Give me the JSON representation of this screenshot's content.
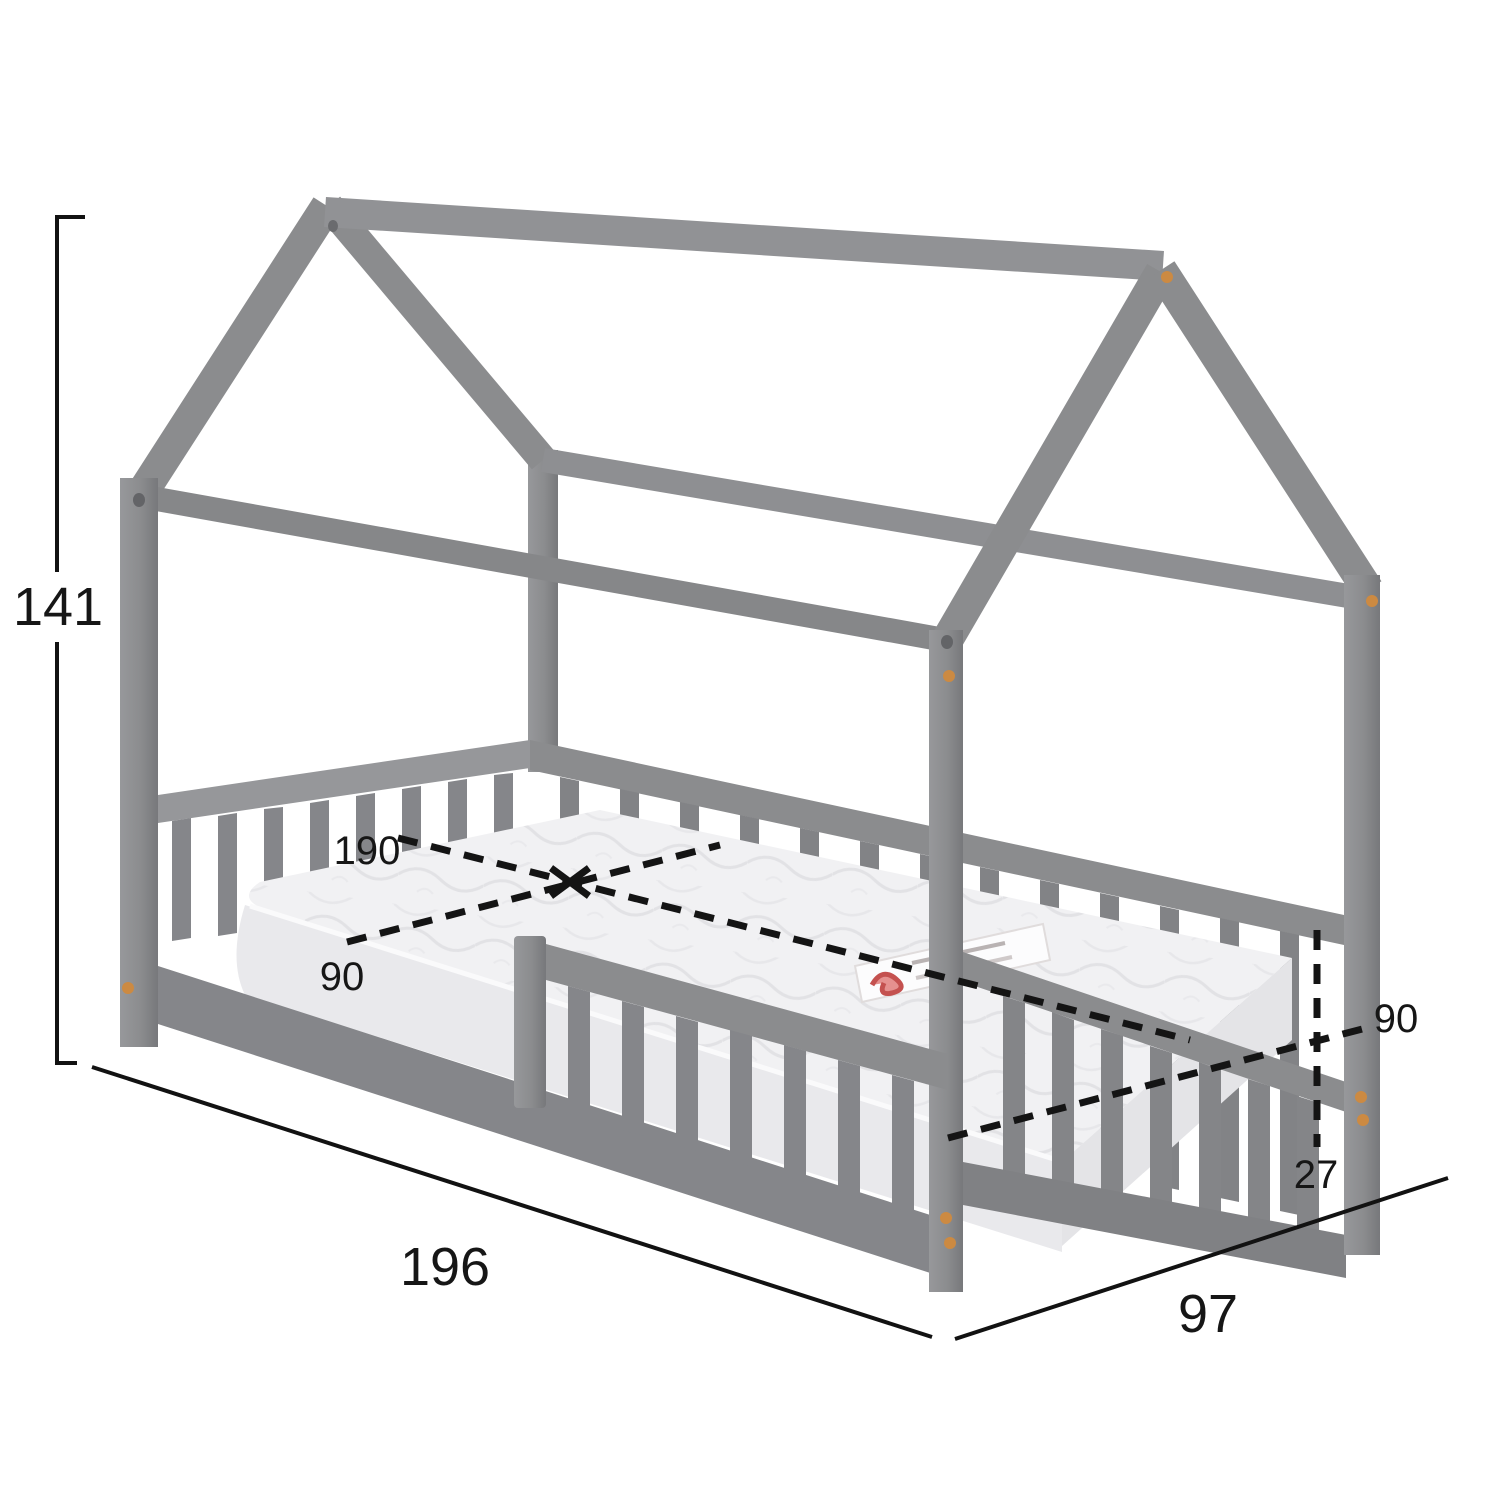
{
  "diagram": {
    "title": "house-bed-dimension-drawing",
    "subject": "kids house-frame bed with slatted rails, safety guard and mattress",
    "colors": {
      "wood": "#8b8c8e",
      "wood_shadow": "#7e7f82",
      "mattress": "#f1f1f3",
      "dowel": "#cc8a42",
      "dimension_line": "#141414",
      "background": "#ffffff"
    },
    "dimensions": {
      "total_height": "141",
      "total_length": "196",
      "total_width": "97",
      "mattress_length": "190",
      "mattress_width": "90",
      "inner_width": "90",
      "rail_height": "27"
    }
  }
}
